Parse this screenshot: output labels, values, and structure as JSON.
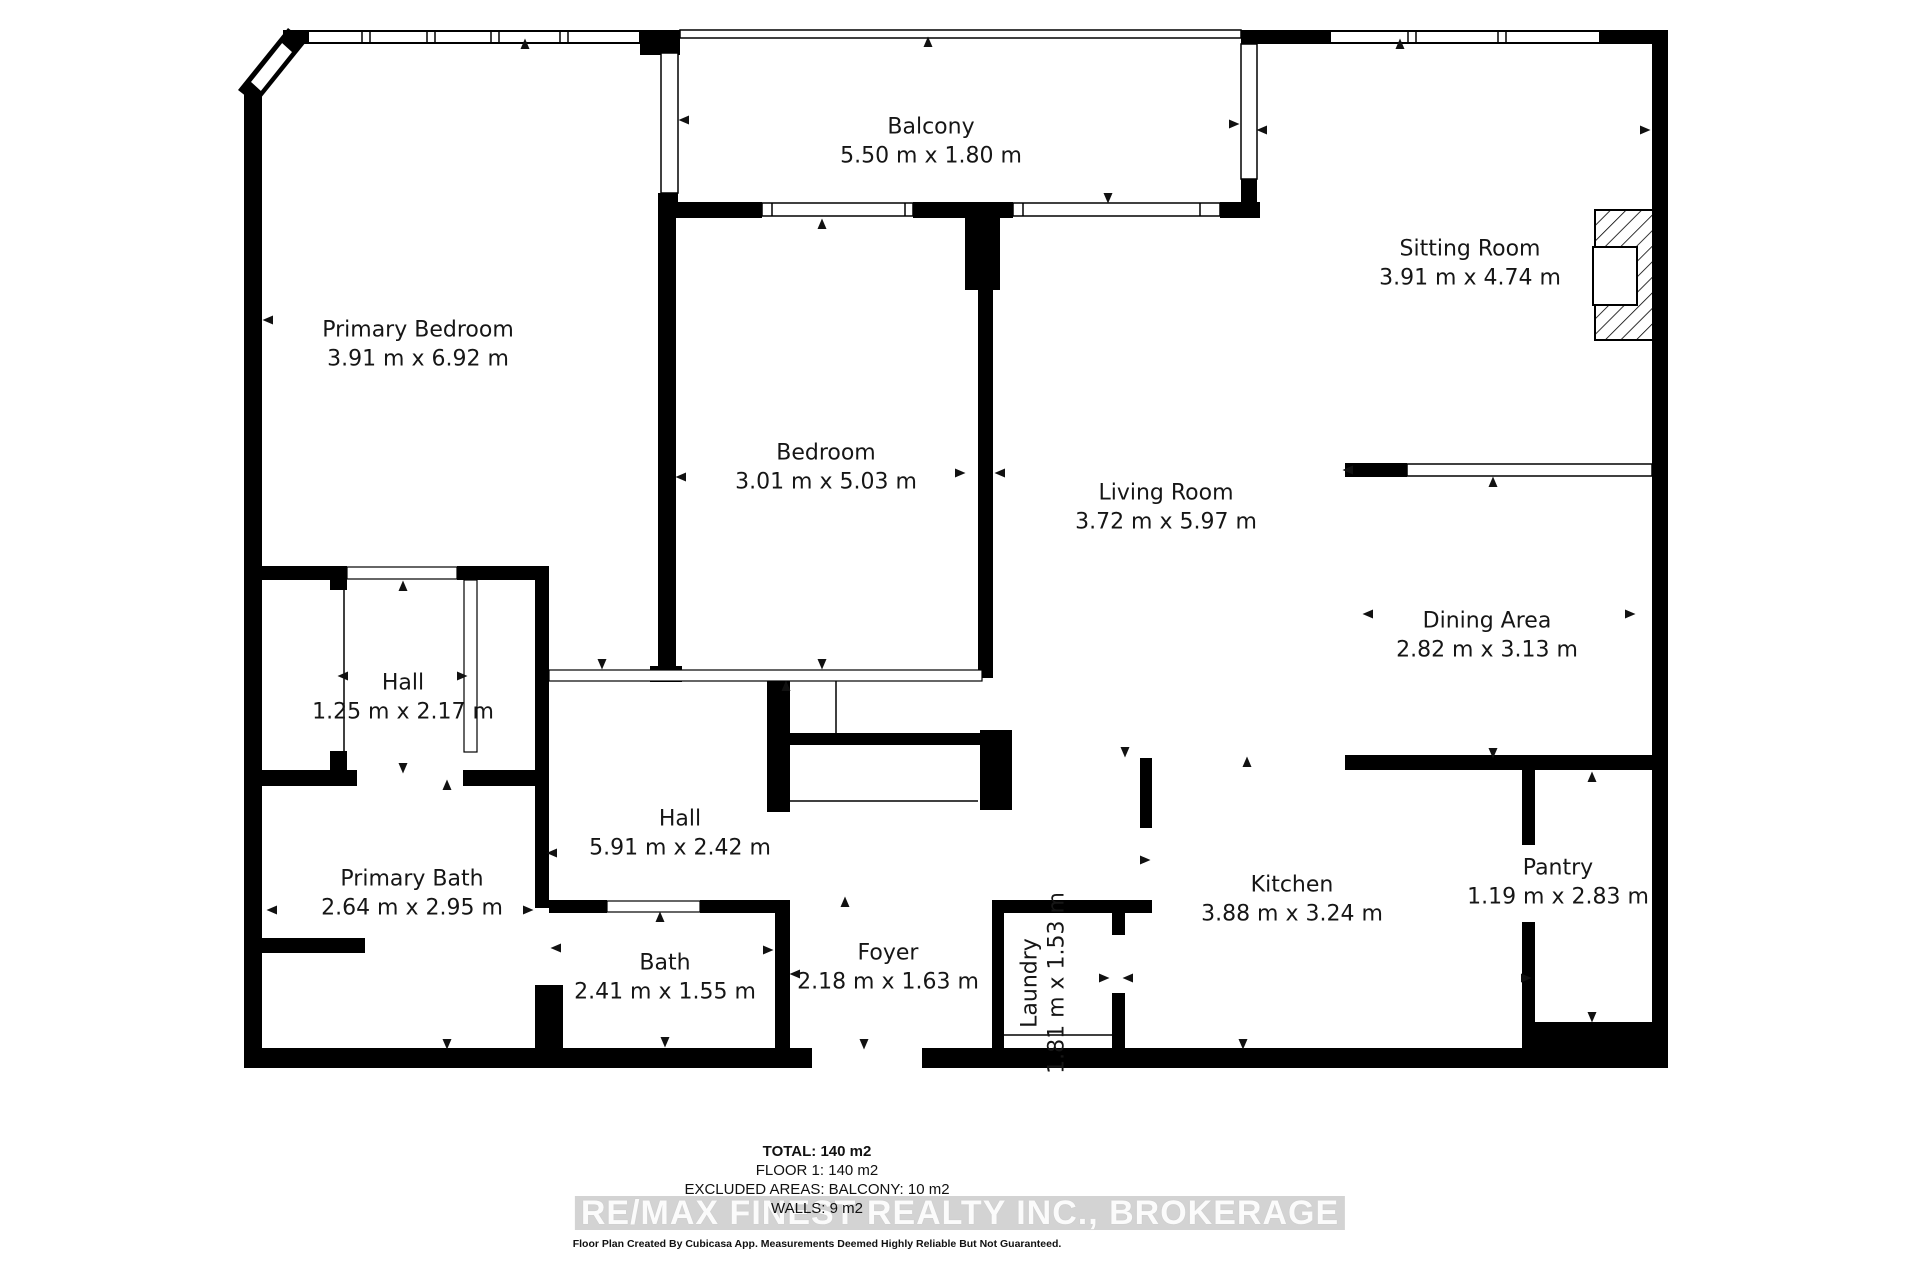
{
  "rooms": [
    {
      "name": "Balcony",
      "dims": "5.50 m x 1.80 m"
    },
    {
      "name": "Primary Bedroom",
      "dims": "3.91 m x 6.92 m"
    },
    {
      "name": "Bedroom",
      "dims": "3.01 m x 5.03 m"
    },
    {
      "name": "Sitting Room",
      "dims": "3.91 m x 4.74 m"
    },
    {
      "name": "Living Room",
      "dims": "3.72 m x 5.97 m"
    },
    {
      "name": "Dining Area",
      "dims": "2.82 m x 3.13 m"
    },
    {
      "name": "Hall",
      "dims": "1.25 m x 2.17 m"
    },
    {
      "name": "Hall",
      "dims": "5.91 m x 2.42 m"
    },
    {
      "name": "Primary Bath",
      "dims": "2.64 m x 2.95 m"
    },
    {
      "name": "Bath",
      "dims": "2.41 m x 1.55 m"
    },
    {
      "name": "Foyer",
      "dims": "2.18 m x 1.63 m"
    },
    {
      "name": "Laundry",
      "dims": "1.81 m x 1.53 m"
    },
    {
      "name": "Kitchen",
      "dims": "3.88 m x 3.24 m"
    },
    {
      "name": "Pantry",
      "dims": "1.19 m x 2.83 m"
    }
  ],
  "summary": {
    "total": "TOTAL: 140 m2",
    "floor": "FLOOR 1: 140 m2",
    "excluded": "EXCLUDED AREAS: BALCONY: 10 m2",
    "walls": "WALLS: 9 m2"
  },
  "watermark": "RE/MAX FINEST REALTY INC., BROKERAGE",
  "disclaimer": "Floor Plan Created By Cubicasa App. Measurements Deemed Highly Reliable But Not Guaranteed.",
  "icons": {
    "measure_arrow": "small black triangle"
  },
  "colors": {
    "wall": "#000000",
    "background": "#ffffff",
    "label_text": "#161616",
    "watermark_band": "#d3d3d3",
    "watermark_text": "#fbfbfb"
  }
}
